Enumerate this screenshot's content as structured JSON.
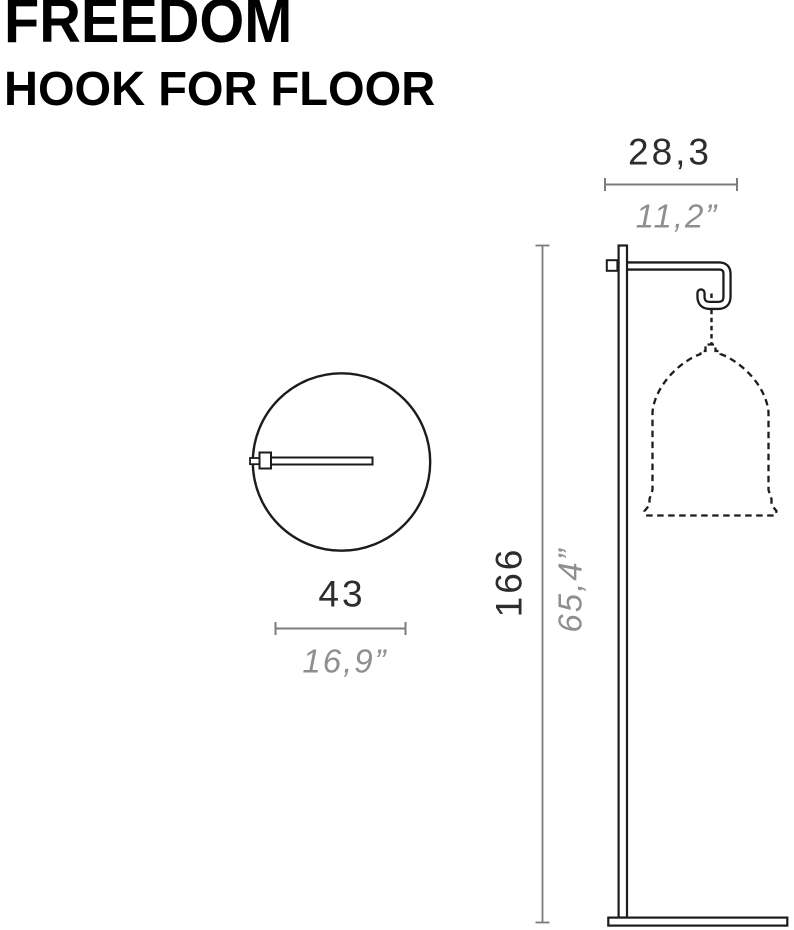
{
  "title": {
    "line1": "FREEDOM",
    "line2": "HOOK FOR FLOOR"
  },
  "views": {
    "front": {
      "label": "front-view-of-floor-hook-with-hanging-shade",
      "dimensions": {
        "width_cm": "28,3",
        "width_in": "11,2”",
        "height_cm": "166",
        "height_in": "65,4”"
      }
    },
    "top": {
      "label": "top-view-circular-base-with-arm",
      "dimensions": {
        "diameter_cm": "43",
        "diameter_in": "16,9”"
      }
    }
  },
  "colors": {
    "background": "#ffffff",
    "drawing_line": "#1c1c1c",
    "dimension_line_gray": "#7c7c7c",
    "dimension_text_dark": "#2d2d2d",
    "dimension_text_light": "#8f8f8f",
    "title_black": "#000000"
  }
}
